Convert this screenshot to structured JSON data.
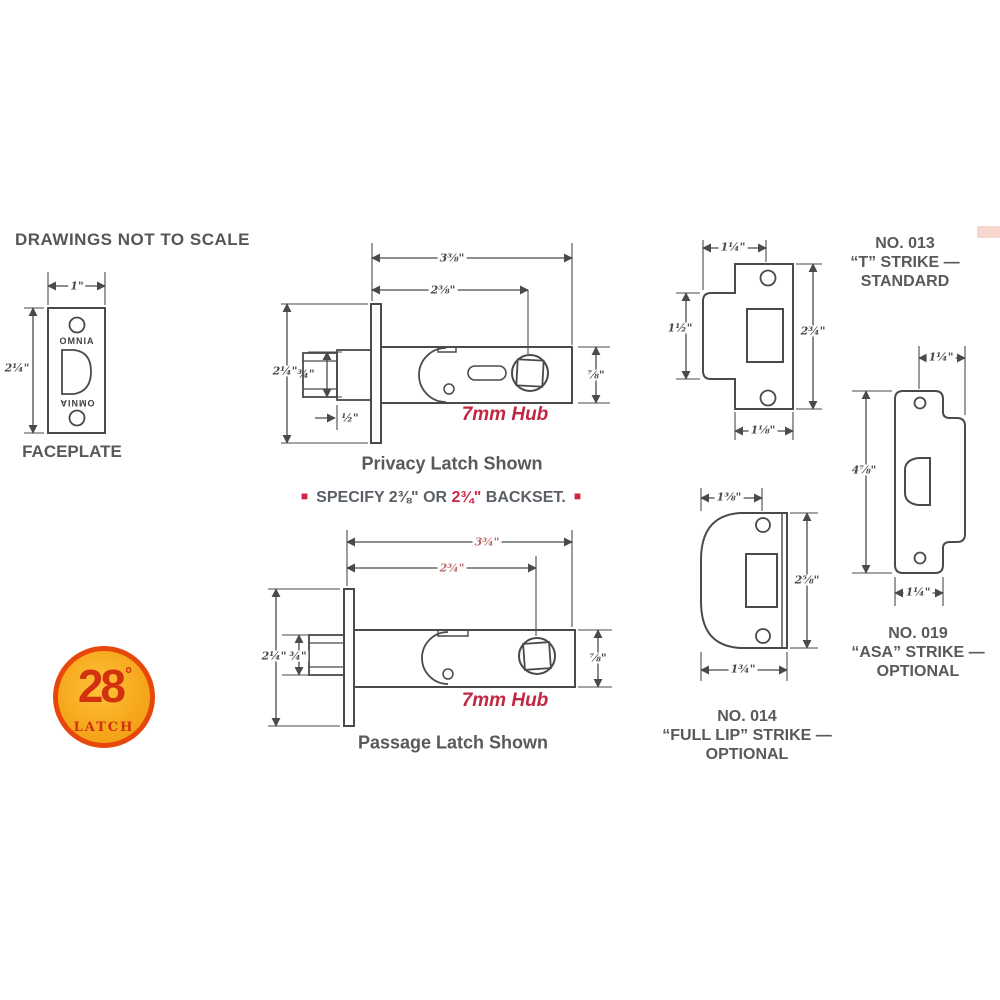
{
  "note": "DRAWINGS NOT TO SCALE",
  "faceplate": {
    "label": "FACEPLATE",
    "brand_top": "OMNIA",
    "brand_bottom": "OMNIA",
    "width": "1\"",
    "height": "2¼\""
  },
  "privacy": {
    "overall": "3⅜\"",
    "backset": "2⅜\"",
    "plate": "2¼\"",
    "bolt": "¾\"",
    "offset": "½\"",
    "case": "⅞\"",
    "hub": "7mm Hub",
    "caption": "Privacy Latch Shown"
  },
  "specify": {
    "lead_square": "■",
    "part1": "SPECIFY 2⅜\" OR",
    "highlight": "2¾\"",
    "part2": "BACKSET.",
    "trail_square": "■"
  },
  "passage": {
    "overall": "3¾\"",
    "backset": "2¾\"",
    "plate": "2¼\"",
    "bolt": "¾\"",
    "case": "⅞\"",
    "hub": "7mm Hub",
    "caption": "Passage Latch Shown"
  },
  "strike013": {
    "no": "NO. 013",
    "name": "“T” STRIKE —",
    "grade": "STANDARD",
    "dim_top": "1¼\"",
    "dim_left": "1½\"",
    "dim_right": "2¾\"",
    "dim_bottom": "1⅛\""
  },
  "strike014": {
    "no": "NO. 014",
    "name": "“FULL LIP” STRIKE —",
    "grade": "OPTIONAL",
    "dim_top": "1⅜\"",
    "dim_right": "2⅝\"",
    "dim_bottom": "1¾\""
  },
  "strike019": {
    "no": "NO. 019",
    "name": "“ASA” STRIKE —",
    "grade": "OPTIONAL",
    "dim_top": "1¼\"",
    "dim_left": "4⅞\"",
    "dim_bottom": "1¼\""
  },
  "logo": {
    "number": "28",
    "degree": "°",
    "word": "LATCH"
  },
  "colors": {
    "line": "#4a4a4a",
    "label_gray": "#595959",
    "accent_red": "#cf2444",
    "dim_red": "#bb6767",
    "logo_fill": "#f5a61a",
    "logo_ring": "#e8470b",
    "logo_text": "#d2310e"
  }
}
